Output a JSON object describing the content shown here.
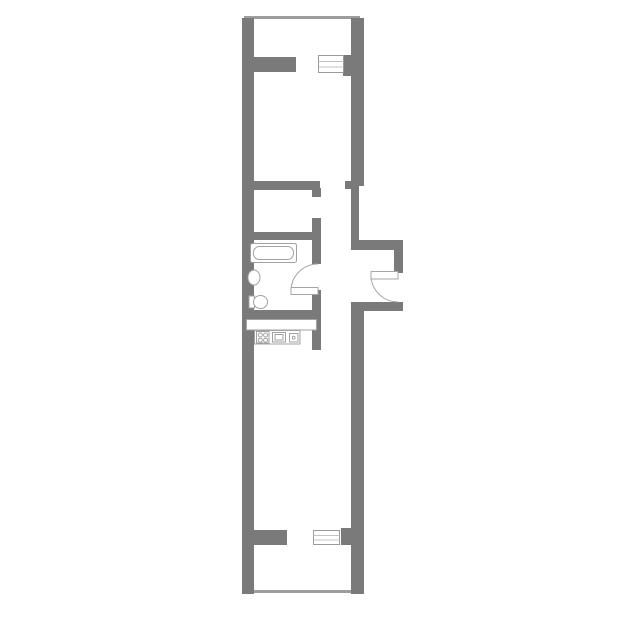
{
  "colors": {
    "background": "#ffffff",
    "wall": "#7a7a7a",
    "parapet": "#9d9d9d",
    "fixture_outline": "#a2a2a2",
    "door_outline": "#a6a6a6",
    "window_outline": "#9a9a9a",
    "window_pane_line": "#c4c4c4"
  },
  "elements": {
    "rooms": [
      "balcony-top",
      "bedroom",
      "hallway",
      "bathroom",
      "entrance-niche",
      "kitchen-living-room",
      "balcony-bottom"
    ],
    "fixtures": [
      "bathtub",
      "washbasin",
      "toilet",
      "kitchen-counter",
      "stove",
      "kitchen-sink",
      "small-appliance"
    ],
    "openings": [
      "window-top",
      "window-bottom",
      "balcony-door-top",
      "balcony-door-bottom",
      "bedroom-doorway",
      "bathroom-door",
      "entrance-door"
    ]
  }
}
